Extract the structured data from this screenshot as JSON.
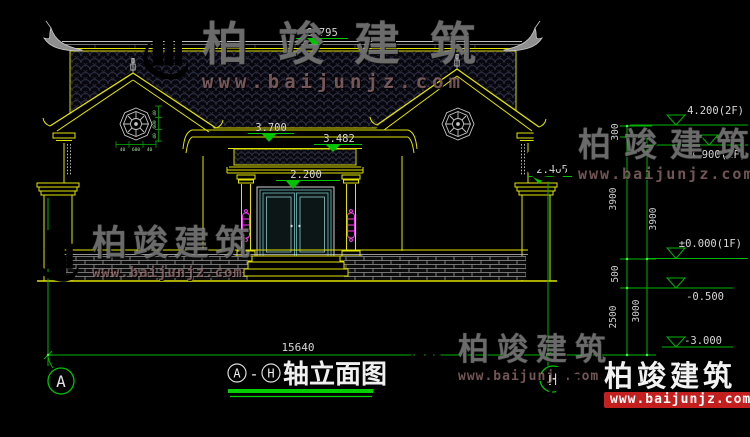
{
  "drawing": {
    "title": {
      "axis_start": "A",
      "separator": "-",
      "axis_end": "H",
      "name": "轴立面图"
    },
    "overall_width_mm": "15640",
    "axis_bubble_left": "A",
    "axis_bubble_right": "H",
    "level_markers": {
      "ridge": "6.795",
      "main_eave": "3.700",
      "porch_canopy": "3.482",
      "door_head": "2.200",
      "side_wall_cap": "2.465"
    },
    "elevation_ladder": {
      "floor2_top": "4.200(2F)",
      "floor2": "3.900(2F)",
      "floor1": "±0.000(1F)",
      "minus_half": "-0.500",
      "minus_three": "-3.000",
      "seg_300": "300",
      "seg_3900_left": "3900",
      "seg_3900_right": "3900",
      "seg_500": "500",
      "seg_2500": "2500",
      "seg_3000": "3000"
    },
    "bagua_window_dims": {
      "w1": "40",
      "w2": "600",
      "w3": "40",
      "v1": "40",
      "v2": "600",
      "v3": "40"
    }
  },
  "watermark": {
    "brand": "柏竣建筑",
    "url": "www.baijunjz.com"
  },
  "colors": {
    "background": "#000000",
    "cad_yellow": "#e3e300",
    "cad_green": "#00c400",
    "dim_text": "#d6d6d6",
    "magenta": "#ff3dff",
    "logo_blue": "#1e63c4",
    "logo_orange": "#f08c1e",
    "url_red": "#c41f1f"
  }
}
